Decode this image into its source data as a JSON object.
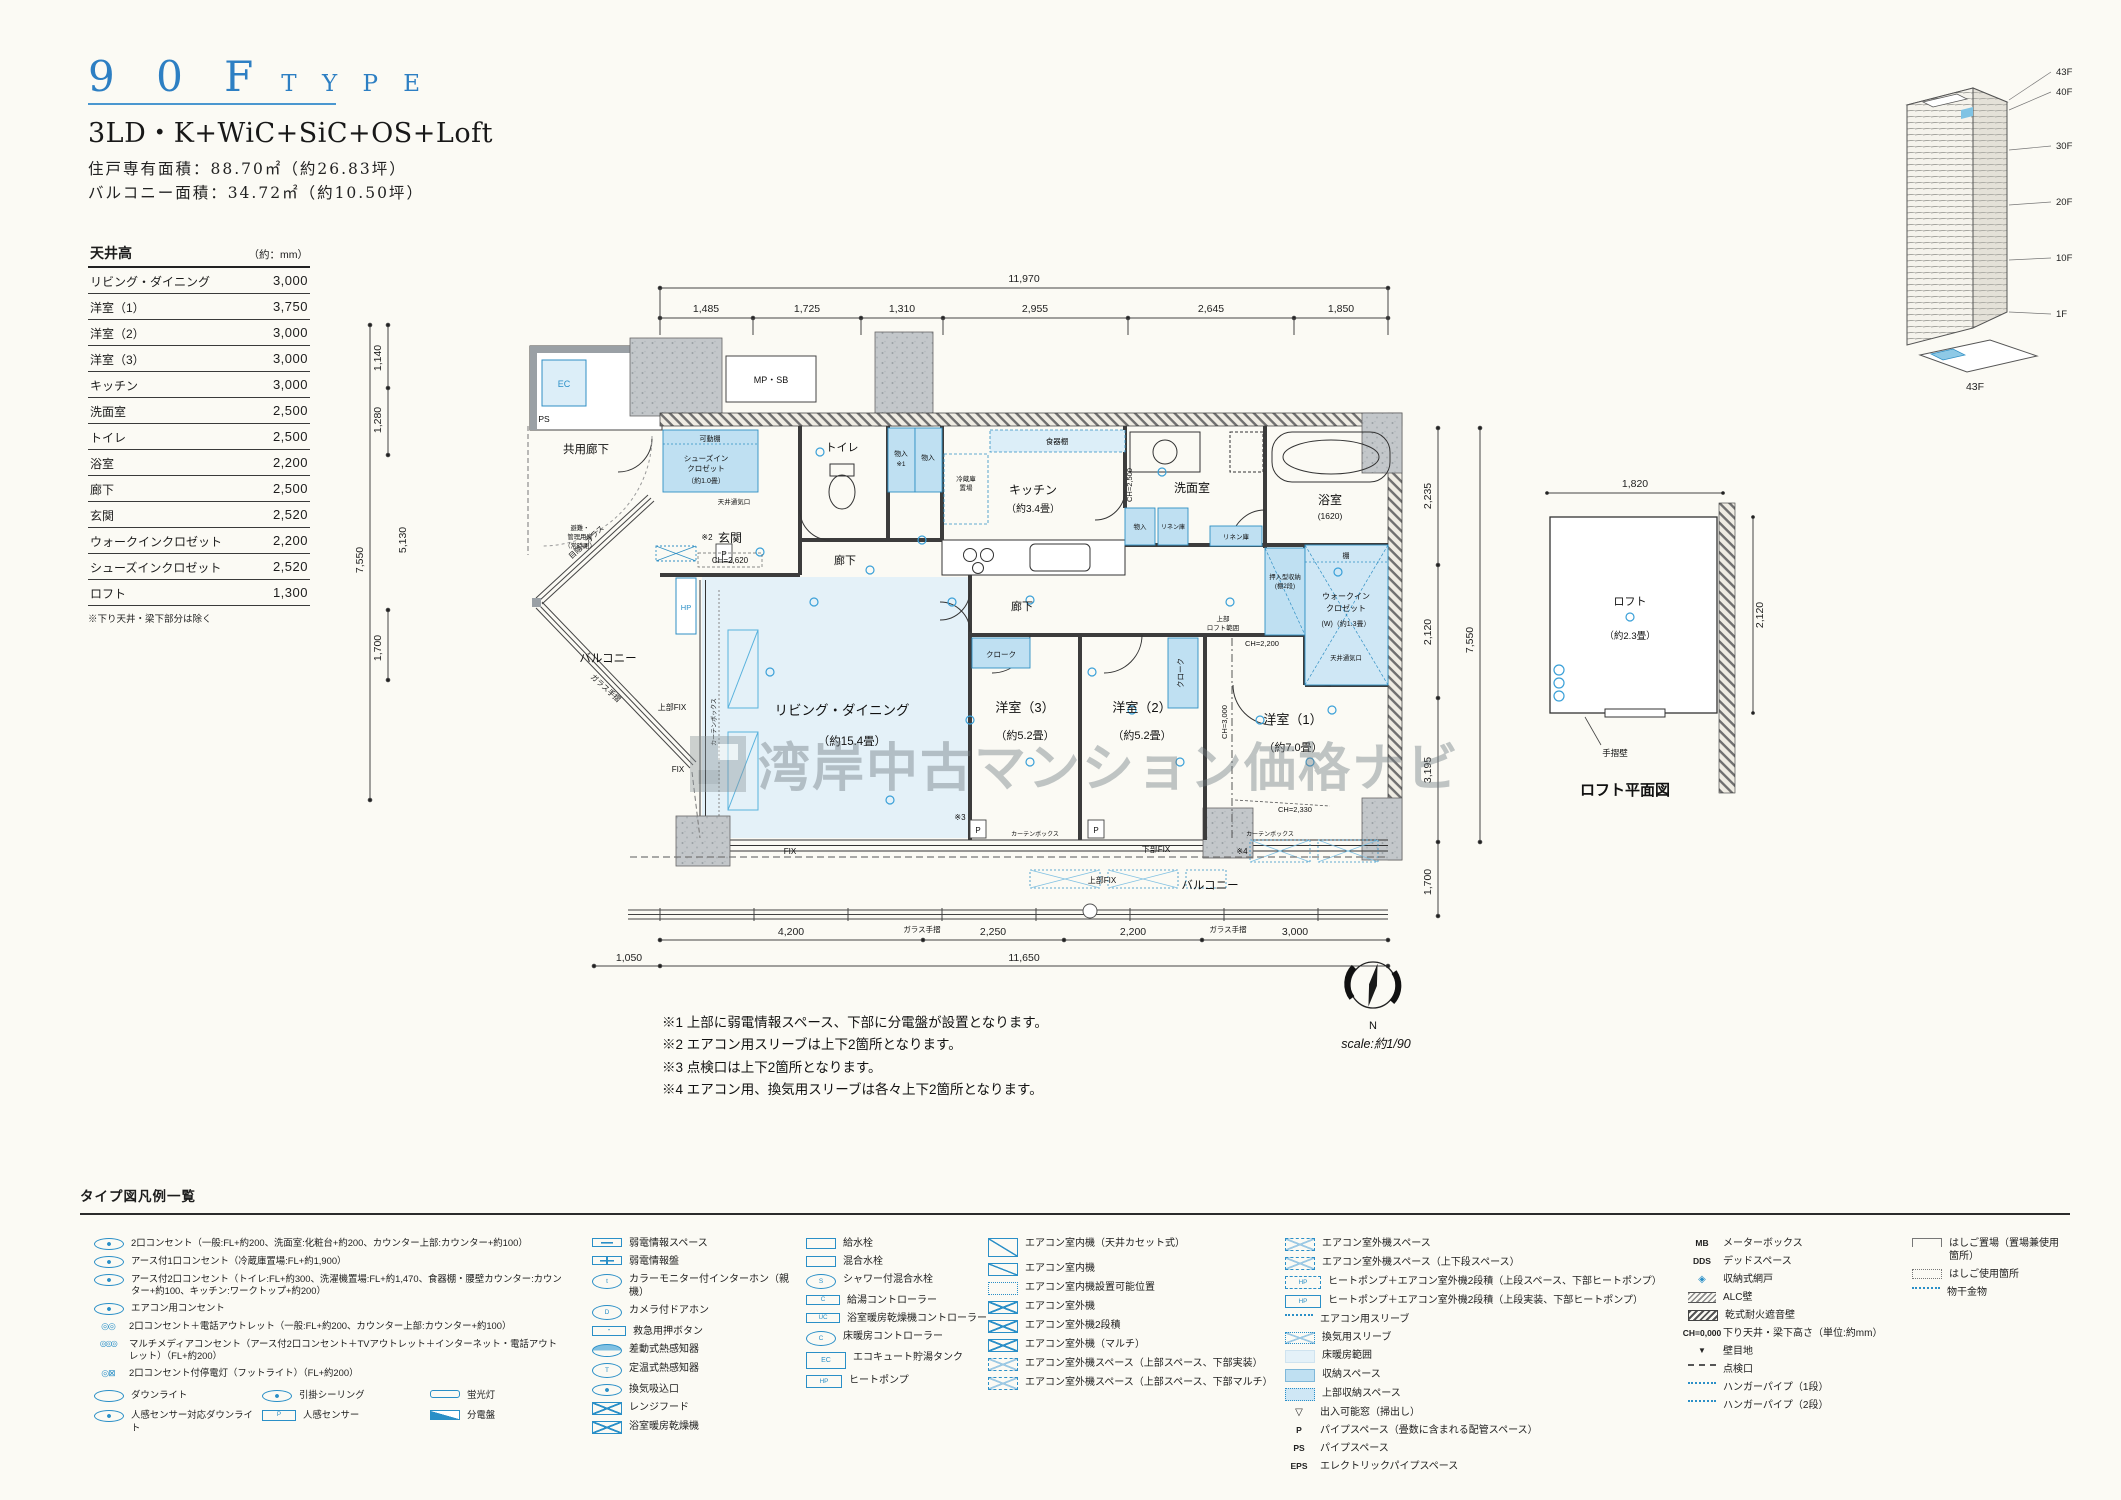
{
  "header": {
    "code": "9 0 F",
    "word": "T Y P E",
    "layout": "3LD・K+WiC+SiC+OS+Loft",
    "area1": "住戸専有面積：88.70㎡（約26.83坪）",
    "area2": "バルコニー面積：34.72㎡（約10.50坪）"
  },
  "ceiling": {
    "title": "天井高",
    "unit": "（約：mm）",
    "rows": [
      {
        "label": "リビング・ダイニング",
        "value": "3,000"
      },
      {
        "label": "洋室（1）",
        "value": "3,750"
      },
      {
        "label": "洋室（2）",
        "value": "3,000"
      },
      {
        "label": "洋室（3）",
        "value": "3,000"
      },
      {
        "label": "キッチン",
        "value": "3,000"
      },
      {
        "label": "洗面室",
        "value": "2,500"
      },
      {
        "label": "トイレ",
        "value": "2,500"
      },
      {
        "label": "浴室",
        "value": "2,200"
      },
      {
        "label": "廊下",
        "value": "2,500"
      },
      {
        "label": "玄関",
        "value": "2,520"
      },
      {
        "label": "ウォークインクロゼット",
        "value": "2,200"
      },
      {
        "label": "シューズインクロゼット",
        "value": "2,520"
      },
      {
        "label": "ロフト",
        "value": "1,300"
      }
    ],
    "note": "※下り天井・梁下部分は除く"
  },
  "plan": {
    "dims": {
      "top_total": "11,970",
      "top": [
        "1,485",
        "1,725",
        "1,310",
        "2,955",
        "2,645",
        "1,850"
      ],
      "right": [
        "2,235",
        "2,120",
        "3,195"
      ],
      "right_total": "7,550",
      "right_balcony": "1,700",
      "left": [
        "1,140",
        "1,280"
      ],
      "left_total": "7,550",
      "left_diag": "5,130",
      "left_balcony": "1,700",
      "bottom": [
        "4,200",
        "2,250",
        "2,200",
        "3,000"
      ],
      "bottom_left": "1,050",
      "bottom_total": "11,650"
    },
    "labels": {
      "kyoyo": "共用廊下",
      "ec": "EC",
      "ps": "PS",
      "mpsb": "MP・SB",
      "kadodana": "可動棚",
      "sic1": "シューズイン",
      "sic2": "クロゼット",
      "sic3": "（約1.0畳）",
      "vent": "天井通気口",
      "genkan": "玄関",
      "genkan_ch": "CH=2,620",
      "toilet": "トイレ",
      "mono": "物入",
      "mono_n": "※1",
      "reizo1": "冷蔵庫",
      "reizo2": "置場",
      "shokki": "食器棚",
      "kitchen": "キッチン",
      "kitchen_sz": "（約3.4畳）",
      "kitchen_ch": "CH=2,500",
      "senmen": "洗面室",
      "bath": "浴室",
      "bath_sz": "(1620)",
      "rinen": "リネン庫",
      "hall": "廊下",
      "oshi1": "押入型収納",
      "oshi2": "(棚2段)",
      "tana": "棚",
      "wic1": "ウォークイン",
      "wic2": "クロゼット",
      "wic3": "(W)（約1.3畳）",
      "loft1": "上部",
      "loft2": "ロフト範囲",
      "ch2200": "CH=2,200",
      "ch3000": "CH=3,000",
      "ch2330": "CH=2,330",
      "ld": "リビング・ダイニング",
      "ld_sz": "（約15.4畳）",
      "y3": "洋室（3）",
      "y3_sz": "（約5.2畳）",
      "y2": "洋室（2）",
      "y2_sz": "（約5.2畳）",
      "y1": "洋室（1）",
      "y1_sz": "（約7.0畳）",
      "cloak": "クローク",
      "balcony": "バルコニー",
      "hinan1": "避難・",
      "hinan2": "管理用扉",
      "hinan3": "（常時閉）",
      "mekakushi": "目隠しガラス",
      "glass": "ガラス手摺",
      "fix_u": "上部FIX",
      "fix": "FIX",
      "fix_l": "下部FIX",
      "curtain": "カーテンボックス",
      "hp": "HP",
      "p": "P",
      "n2": "※2",
      "n3": "※3",
      "n4": "※4"
    },
    "notes": [
      "※1 上部に弱電情報スペース、下部に分電盤が設置となります。",
      "※2 エアコン用スリーブは上下2箇所となります。",
      "※3 点検口は上下2箇所となります。",
      "※4 エアコン用、換気用スリーブは各々上下2箇所となります。"
    ],
    "compass": "N",
    "scale": "scale:約1/90"
  },
  "watermark": "湾岸中古マンション価格ナビ",
  "loft": {
    "dim_w": "1,820",
    "dim_h": "2,120",
    "name": "ロフト",
    "size": "（約2.3畳）",
    "wall": "手摺壁",
    "caption": "ロフト平面図"
  },
  "tower": {
    "floors": [
      "43F",
      "40F",
      "30F",
      "20F",
      "10F",
      "1F"
    ],
    "caption": "43F"
  },
  "legend": {
    "title": "タイプ図凡例一覧",
    "c1": [
      {
        "ic": "ic-o2",
        "label": "2口コンセント（一般:FL+約200、洗面室:化粧台+約200、カウンター上部:カウンター+約100）"
      },
      {
        "ic": "ic-o2",
        "label": "アース付1口コンセント（冷蔵庫置場:FL+約1,900）"
      },
      {
        "ic": "ic-o2",
        "label": "アース付2口コンセント（トイレ:FL+約300、洗濯機置場:FL+約1,470、食器棚・腰壁カウンター:カウンター+約100、キッチン:ワークトップ+約200）"
      },
      {
        "ic": "ic-o2",
        "label": "エアコン用コンセント"
      },
      {
        "ic": "ic-oo",
        "label": "2口コンセント＋電話アウトレット（一般:FL+約200、カウンター上部:カウンター+約100）"
      },
      {
        "ic": "ic-ooo",
        "label": "マルチメディアコンセント（アース付2口コンセント＋TVアウトレット＋インターネット・電話アウトレット）（FL+約200）"
      },
      {
        "ic": "ic-ox",
        "label": "2口コンセント付停電灯（フットライト）（FL+約200）"
      }
    ],
    "c1x": [
      {
        "ic": "ic-o",
        "label": "ダウンライト"
      },
      {
        "ic": "ic-o2",
        "label": "引掛シーリング"
      },
      {
        "ic": "ic-fl",
        "label": "蛍光灯"
      },
      {
        "ic": "ic-o2",
        "label": "人感センサー対応ダウンライト"
      },
      {
        "ic": "ic-txtbox",
        "sym": "P",
        "label": "人感センサー"
      },
      {
        "ic": "ic-bb",
        "label": "分電盤"
      }
    ],
    "c2": [
      {
        "ic": "ic-bar",
        "label": "弱電情報スペース"
      },
      {
        "ic": "ic-bar2",
        "label": "弱電情報盤"
      },
      {
        "ic": "ic-ot",
        "sym": "t",
        "label": "カラーモニター付インターホン（親機）"
      },
      {
        "ic": "ic-ot",
        "sym": "D",
        "label": "カメラ付ドアホン"
      },
      {
        "ic": "ic-txtbox",
        "sym": "・",
        "label": "救急用押ボタン"
      },
      {
        "ic": "ic-half",
        "label": "差動式熱感知器"
      },
      {
        "ic": "ic-ot",
        "sym": "T",
        "label": "定温式熱感知器"
      },
      {
        "ic": "ic-o2",
        "label": "換気吸込口"
      },
      {
        "ic": "ic-sqx",
        "label": "レンジフード"
      },
      {
        "ic": "ic-sqx",
        "label": "浴室暖房乾燥機"
      }
    ],
    "c3": [
      {
        "ic": "ic-sq",
        "label": "給水栓"
      },
      {
        "ic": "ic-sq",
        "label": "混合水栓"
      },
      {
        "ic": "ic-ot",
        "sym": "S",
        "label": "シャワー付混合水栓"
      },
      {
        "ic": "ic-txtbox",
        "sym": "C",
        "label": "給湯コントローラー"
      },
      {
        "ic": "ic-txtbox",
        "sym": "UC",
        "label": "浴室暖房乾燥機コントローラー"
      },
      {
        "ic": "ic-ot",
        "sym": "C",
        "label": "床暖房コントローラー"
      },
      {
        "ic": "ic-ecbox",
        "sym": "EC",
        "label": "エコキュート貯湯タンク"
      },
      {
        "ic": "ic-hpbox2",
        "sym": "HP",
        "label": "ヒートポンプ"
      }
    ],
    "c4": [
      {
        "ic": "ic-sqsl-lg",
        "label": "エアコン室内機（天井カセット式）"
      },
      {
        "ic": "ic-sqsl",
        "label": "エアコン室内機"
      },
      {
        "ic": "ic-sqdot",
        "label": "エアコン室内機設置可能位置"
      },
      {
        "ic": "ic-sqx",
        "label": "エアコン室外機"
      },
      {
        "ic": "ic-sqx",
        "label": "エアコン室外機2段積"
      },
      {
        "ic": "ic-sqx",
        "label": "エアコン室外機（マルチ）"
      },
      {
        "ic": "ic-sqxd",
        "label": "エアコン室外機スペース（上部スペース、下部実装）"
      },
      {
        "ic": "ic-sqxd",
        "label": "エアコン室外機スペース（上部スペース、下部マルチ）"
      }
    ],
    "c5": [
      {
        "ic": "ic-sqxd",
        "label": "エアコン室外機スペース"
      },
      {
        "ic": "ic-sqxd",
        "label": "エアコン室外機スペース（上下段スペース）"
      },
      {
        "ic": "ic-hpbox",
        "sym": "HP",
        "label": "ヒートポンプ＋エアコン室外機2段積（上段スペース、下部ヒートポンプ）"
      },
      {
        "ic": "ic-hpbox2",
        "sym": "HP",
        "label": "ヒートポンプ＋エアコン室外機2段積（上段実装、下部ヒートポンプ）"
      },
      {
        "ic": "ic-dots",
        "label": "エアコン用スリーブ"
      },
      {
        "ic": "ic-xdots",
        "label": "換気用スリーブ"
      },
      {
        "ic": "ic-heat",
        "label": "床暖房範囲"
      },
      {
        "ic": "ic-sqfill",
        "label": "収納スペース"
      },
      {
        "ic": "ic-sqfilld",
        "label": "上部収納スペース"
      },
      {
        "ic": "ic-glyph",
        "sym": "▽",
        "label": "出入可能窓（掃出し）"
      },
      {
        "ic": "ic-txt",
        "sym": "P",
        "label": "パイプスペース（畳数に含まれる配管スペース）"
      },
      {
        "ic": "ic-txt",
        "sym": "PS",
        "label": "パイプスペース"
      },
      {
        "ic": "ic-txt",
        "sym": "EPS",
        "label": "エレクトリックパイプスペース"
      }
    ],
    "c6": [
      {
        "ic": "ic-txt",
        "sym": "MB",
        "label": "メーターボックス"
      },
      {
        "ic": "ic-txt",
        "sym": "DDS",
        "label": "デッドスペース"
      },
      {
        "ic": "ic-net",
        "sym": "◈",
        "label": "収納式網戸"
      },
      {
        "ic": "ic-hatch",
        "label": "ALC壁"
      },
      {
        "ic": "ic-hatch2",
        "label": "乾式耐火遮音壁"
      },
      {
        "ic": "ic-txt",
        "sym": "CH=0,000",
        "label": "下り天井・梁下高さ（単位:約mm）"
      },
      {
        "ic": "ic-glyph-b",
        "sym": "▼",
        "label": "壁目地"
      },
      {
        "ic": "ic-dashes",
        "label": "点検口"
      },
      {
        "ic": "ic-dots",
        "label": "ハンガーパイプ（1段）"
      },
      {
        "ic": "ic-dots",
        "label": "ハンガーパイプ（2段）"
      }
    ],
    "c7": [
      {
        "ic": "ic-lad",
        "label": "はしご置場（置場兼使用箇所）"
      },
      {
        "ic": "ic-ladd",
        "label": "はしご使用箇所"
      },
      {
        "ic": "ic-dots",
        "label": "物干金物"
      }
    ]
  }
}
